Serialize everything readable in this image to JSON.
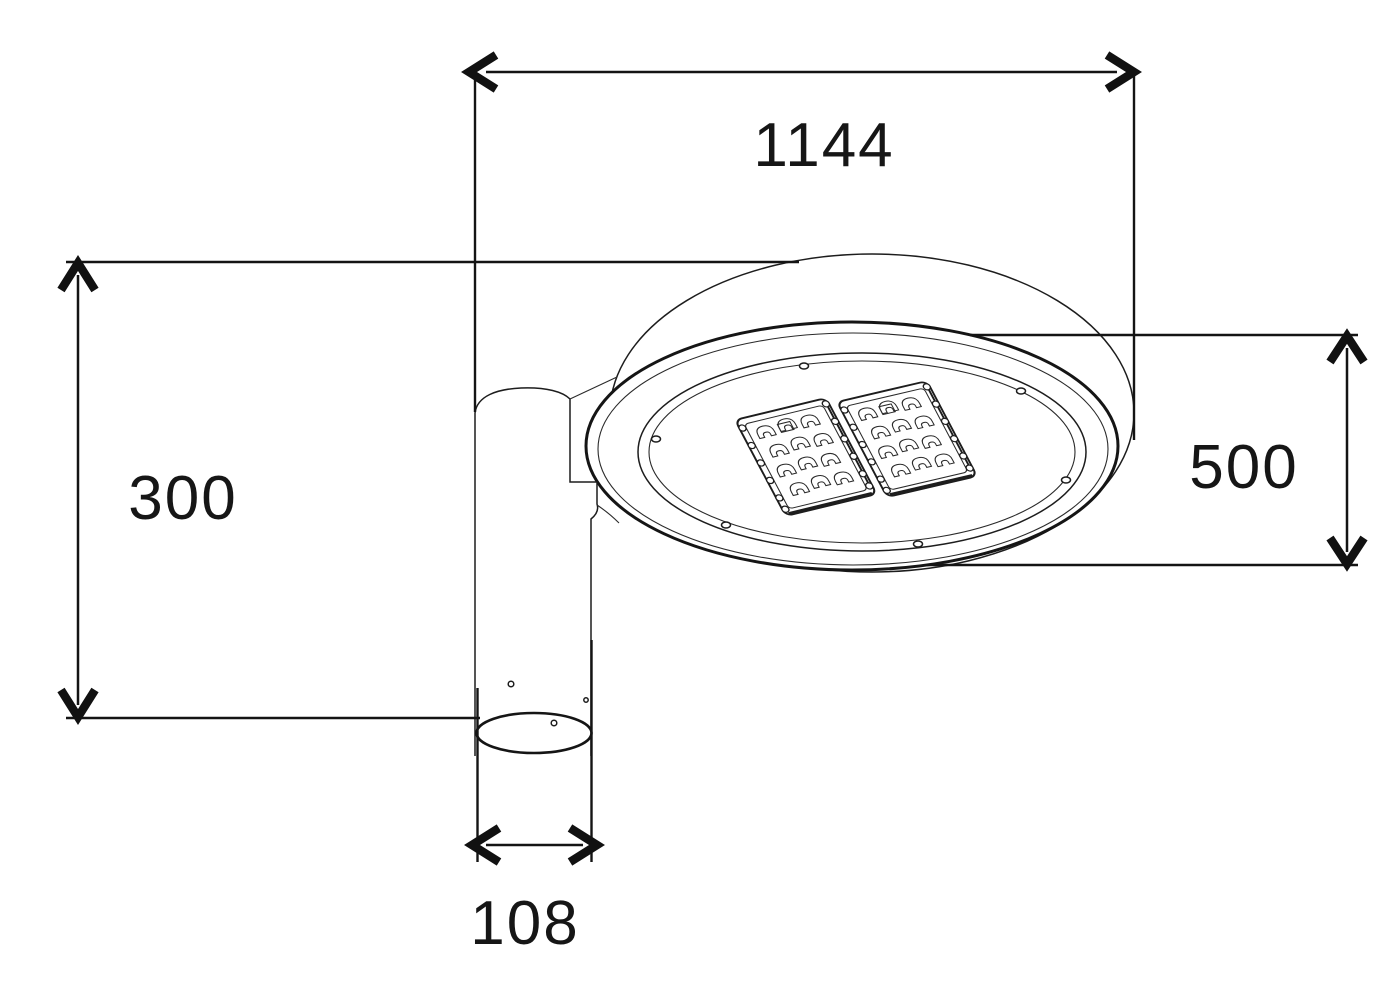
{
  "drawing": {
    "description": "Street luminaire dimension drawing",
    "dimensions": {
      "top_width": "1144",
      "left_height": "300",
      "head_diameter": "500",
      "pole_diameter": "108"
    },
    "led_module_count": 2,
    "colors": {
      "ink": "#1d1d1d",
      "paper": "#ffffff"
    }
  }
}
